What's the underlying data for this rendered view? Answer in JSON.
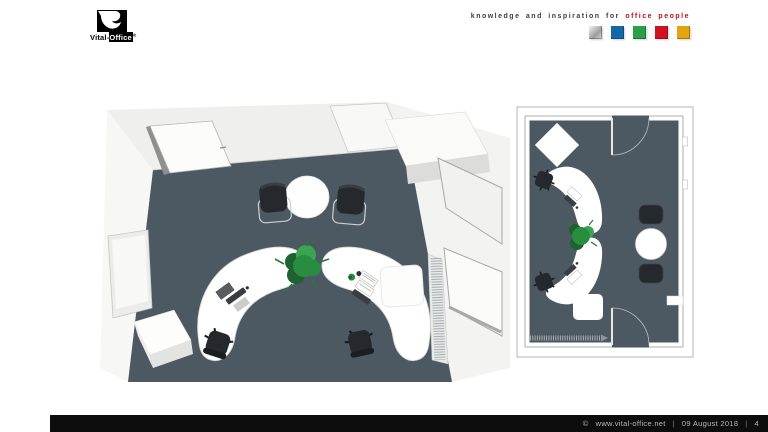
{
  "header": {
    "logo": {
      "brand_prefix": "Vital-",
      "brand_suffix": "Office",
      "registered": "®"
    },
    "tagline": {
      "lead": "knowledge and inspiration for ",
      "highlight": "office people"
    },
    "color_squares": [
      {
        "name": "silver",
        "color": "#c9c9c9"
      },
      {
        "name": "blue",
        "color": "#1568a8"
      },
      {
        "name": "green",
        "color": "#2ba04a"
      },
      {
        "name": "red",
        "color": "#d01122"
      },
      {
        "name": "gold",
        "color": "#e0a60b"
      }
    ]
  },
  "footer": {
    "copyright": "©",
    "website": "www.vital-office.net",
    "separator": "|",
    "date": "09 August 2018",
    "page_number": "4"
  },
  "colors": {
    "floor": "#4d5962",
    "wall": "#f0f0ee",
    "wall_shade": "#dededc",
    "frame_gray": "#9a9a98",
    "desk": "#ffffff",
    "chair": "#25282c",
    "chair_dark": "#1b1e21",
    "plant": "#2a8c3f",
    "plant_light": "#3aa452",
    "plant_dark": "#1c6330",
    "tagline_gray": "#3c3c3c",
    "brand_red": "#c00d1d",
    "footer_bg": "#0d0d0d",
    "footer_text": "#b8b8b8"
  }
}
